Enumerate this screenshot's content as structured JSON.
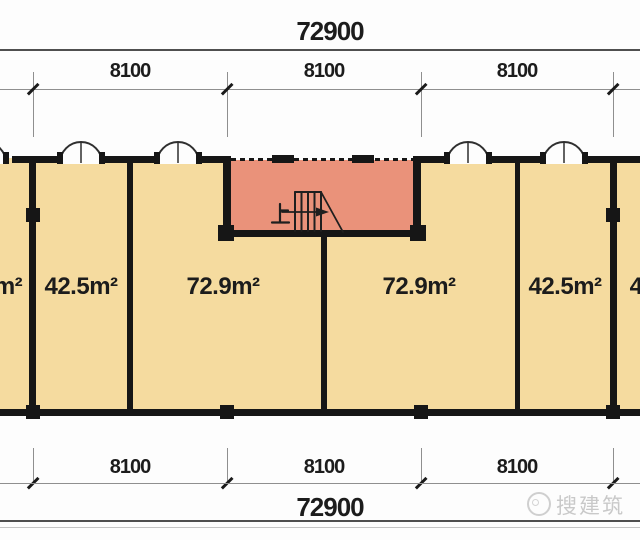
{
  "dimensions": {
    "top": {
      "total": "72900",
      "spans": [
        "8100",
        "8100",
        "8100"
      ]
    },
    "bottom": {
      "total": "72900",
      "spans": [
        "8100",
        "8100",
        "8100"
      ]
    }
  },
  "rooms": [
    {
      "area_label": "m²"
    },
    {
      "area_label": "42.5m²"
    },
    {
      "area_label": "72.9m²"
    },
    {
      "area_label": "72.9m²"
    },
    {
      "area_label": "42.5m²"
    },
    {
      "area_label": "4"
    }
  ],
  "stairwell": {
    "direction_label": "上"
  },
  "watermark": {
    "text": "搜建筑"
  },
  "colors": {
    "room_fill": "#f5db9f",
    "stairwell_fill": "#ea927a",
    "wall": "#161616",
    "dim_line": "#8f8f8f",
    "frame_line": "#4f4f4f",
    "text": "#1c1c1c",
    "watermark": "#c9c9c9"
  }
}
